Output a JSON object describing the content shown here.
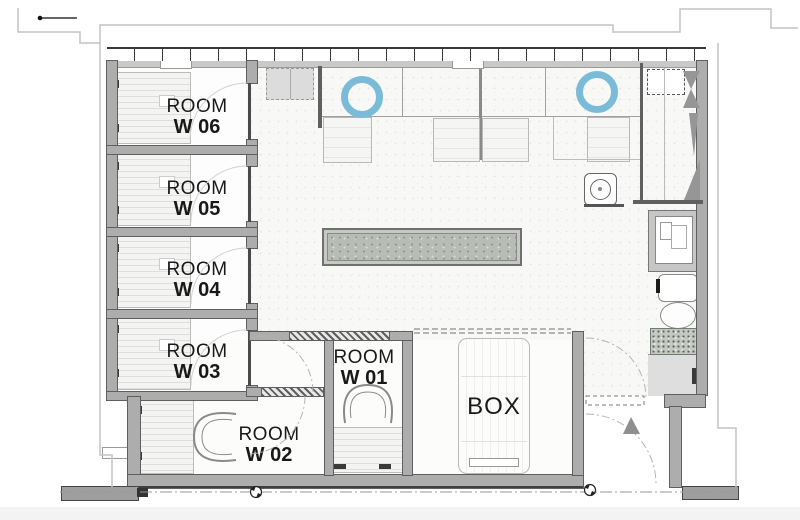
{
  "rooms": [
    {
      "name": "ROOM",
      "number": "W 06"
    },
    {
      "name": "ROOM",
      "number": "W 05"
    },
    {
      "name": "ROOM",
      "number": "W 04"
    },
    {
      "name": "ROOM",
      "number": "W 03"
    },
    {
      "name": "ROOM",
      "number": "W 02"
    },
    {
      "name": "ROOM",
      "number": "W 01"
    },
    {
      "name": "BOX"
    }
  ],
  "colors": {
    "accent_blue": "#7abcd7",
    "wall_gray": "#adadad",
    "wall_edge": "#5f5f5f",
    "planter_fill": "#b7bcb4",
    "label_text": "#191919"
  },
  "icons": {
    "ceiling_light": "ceiling-light-icon",
    "rotation_marker": "rotation-marker-icon",
    "entrance_arrow": "entrance-arrow-icon",
    "leader_dot": "leader-line-icon",
    "plant": "plant-icon"
  }
}
